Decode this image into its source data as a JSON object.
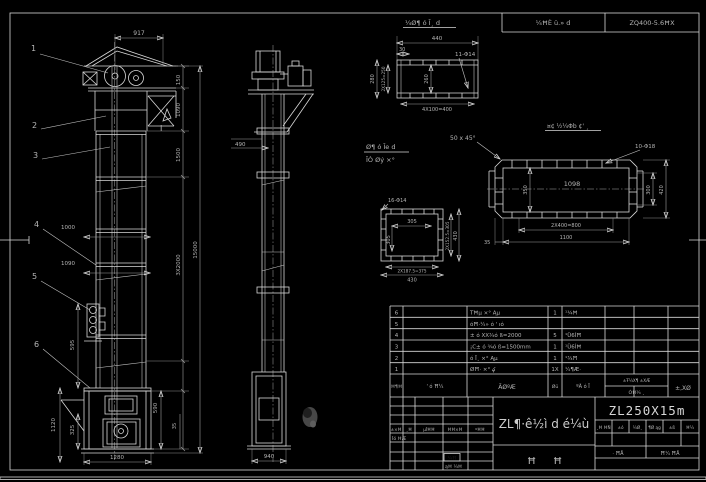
{
  "colors": {
    "background": "#000000",
    "line": "#d8d8d8",
    "dim_text": "#b5b5b5",
    "highlight": "#8a8a8a"
  },
  "top_table": {
    "left_cell": "¼ĦÈ ü.» d",
    "right_cell": "ZQ400-5.6ĦX"
  },
  "front_view": {
    "callouts": [
      "1",
      "2",
      "3",
      "4",
      "5",
      "6"
    ],
    "dim_917": "917",
    "dim_150": "150",
    "dim_1090": "1090",
    "dim_1500": "1500",
    "dim_15000": "15000",
    "dim_3x2000": "3X2000",
    "dim_1000": "1000",
    "dim_1090b": "1090",
    "dim_595": "595",
    "dim_1120": "1120",
    "dim_325": "325",
    "dim_590": "590",
    "dim_35": "35",
    "dim_1280": "1280",
    "section_mark": "I"
  },
  "side_view": {
    "dim_490": "490",
    "dim_940": "940"
  },
  "detail_top": {
    "title": "¼Ø¶ ó Ī¸ d",
    "dim_440": "440",
    "dim_30": "30",
    "holes": "11-Φ14",
    "dim_260": "260",
    "dim_280": "280",
    "dim_2x125": "2X125=250",
    "dim_4x100": "4X100=400"
  },
  "detail_square": {
    "label_line1": "Ø¶ ó Īe d",
    "label_line2": "ĪÒ Øý ×°",
    "holes": "16-Φ14",
    "dim_305h": "305",
    "dim_305v": "305",
    "dim_2x152": "2X152.5=305",
    "dim_430r": "430",
    "dim_2x187": "2X187.5=375",
    "dim_430b": "430"
  },
  "detail_plate": {
    "title": "¤¢ ½¼Φb ¢' ¸",
    "chamfer": "50 x 45°",
    "holes": "10-Φ18",
    "dim_1098": "1098",
    "dim_350": "350",
    "dim_300": "300",
    "dim_420": "420",
    "dim_2x400": "2X400=800",
    "dim_1100": "1100",
    "dim_35": "35"
  },
  "bom": {
    "header": {
      "no": "Ħ¶Ħ",
      "code": "' ó Ħ¼",
      "name": "ÃØºÆ",
      "qty": "Øü",
      "material": "ºÃ ó Ī",
      "weight_top": "±Ŧ¼X¶ ±XÆ",
      "weight_bottom": "ÓĦ¼ ¸",
      "notes": "±,XØ"
    },
    "rows": [
      {
        "no": "6",
        "code": "",
        "name": "TĦµ ×° Ąµ",
        "qty": "1",
        "material": "¹¾Ħ"
      },
      {
        "no": "5",
        "code": "",
        "name": "óĦ·¼» ó ' ıó",
        "qty": "",
        "material": ""
      },
      {
        "no": "4",
        "code": "",
        "name": "± ó XX¾ó ß=2000",
        "qty": "5",
        "material": "¹Ü6ÍĦ"
      },
      {
        "no": "3",
        "code": "",
        "name": "¡C± ó ¾ó ß=1500mm",
        "qty": "1",
        "material": "¹Ü6ÍĦ"
      },
      {
        "no": "2",
        "code": "",
        "name": "ó Ī¸ ×° Ąµ",
        "qty": "1",
        "material": "¹¾Ħ"
      },
      {
        "no": "1",
        "code": "",
        "name": "ØĦ· ×° ؼ",
        "qty": "1X",
        "material": "¼¶Æ·"
      }
    ]
  },
  "title_block": {
    "model": "ZL250X15m",
    "main_title": "ZL¶·ê½ì d é¼ù",
    "glyph1": "Ħ",
    "glyph2": "Ħ",
    "rev_cols": [
      "±×Ħ",
      "¸Ħ",
      "µĪĦĦ",
      "ĦĦ×Ħ",
      "ºĦĦ"
    ],
    "row_design": "Īó ĦÆ",
    "row_std": "ąĦ ¼Ħ",
    "highlight_cell": "¼Ħ",
    "labels_row": [
      "¸Ħ ĦÑ",
      "±ó",
      "¼Ø¸",
      "¶Ø ąg",
      "±ß",
      "Ħ¼"
    ],
    "sheets_left": "· ĦÅ",
    "sheets_right": "Ħ¼ ĦÅ"
  }
}
